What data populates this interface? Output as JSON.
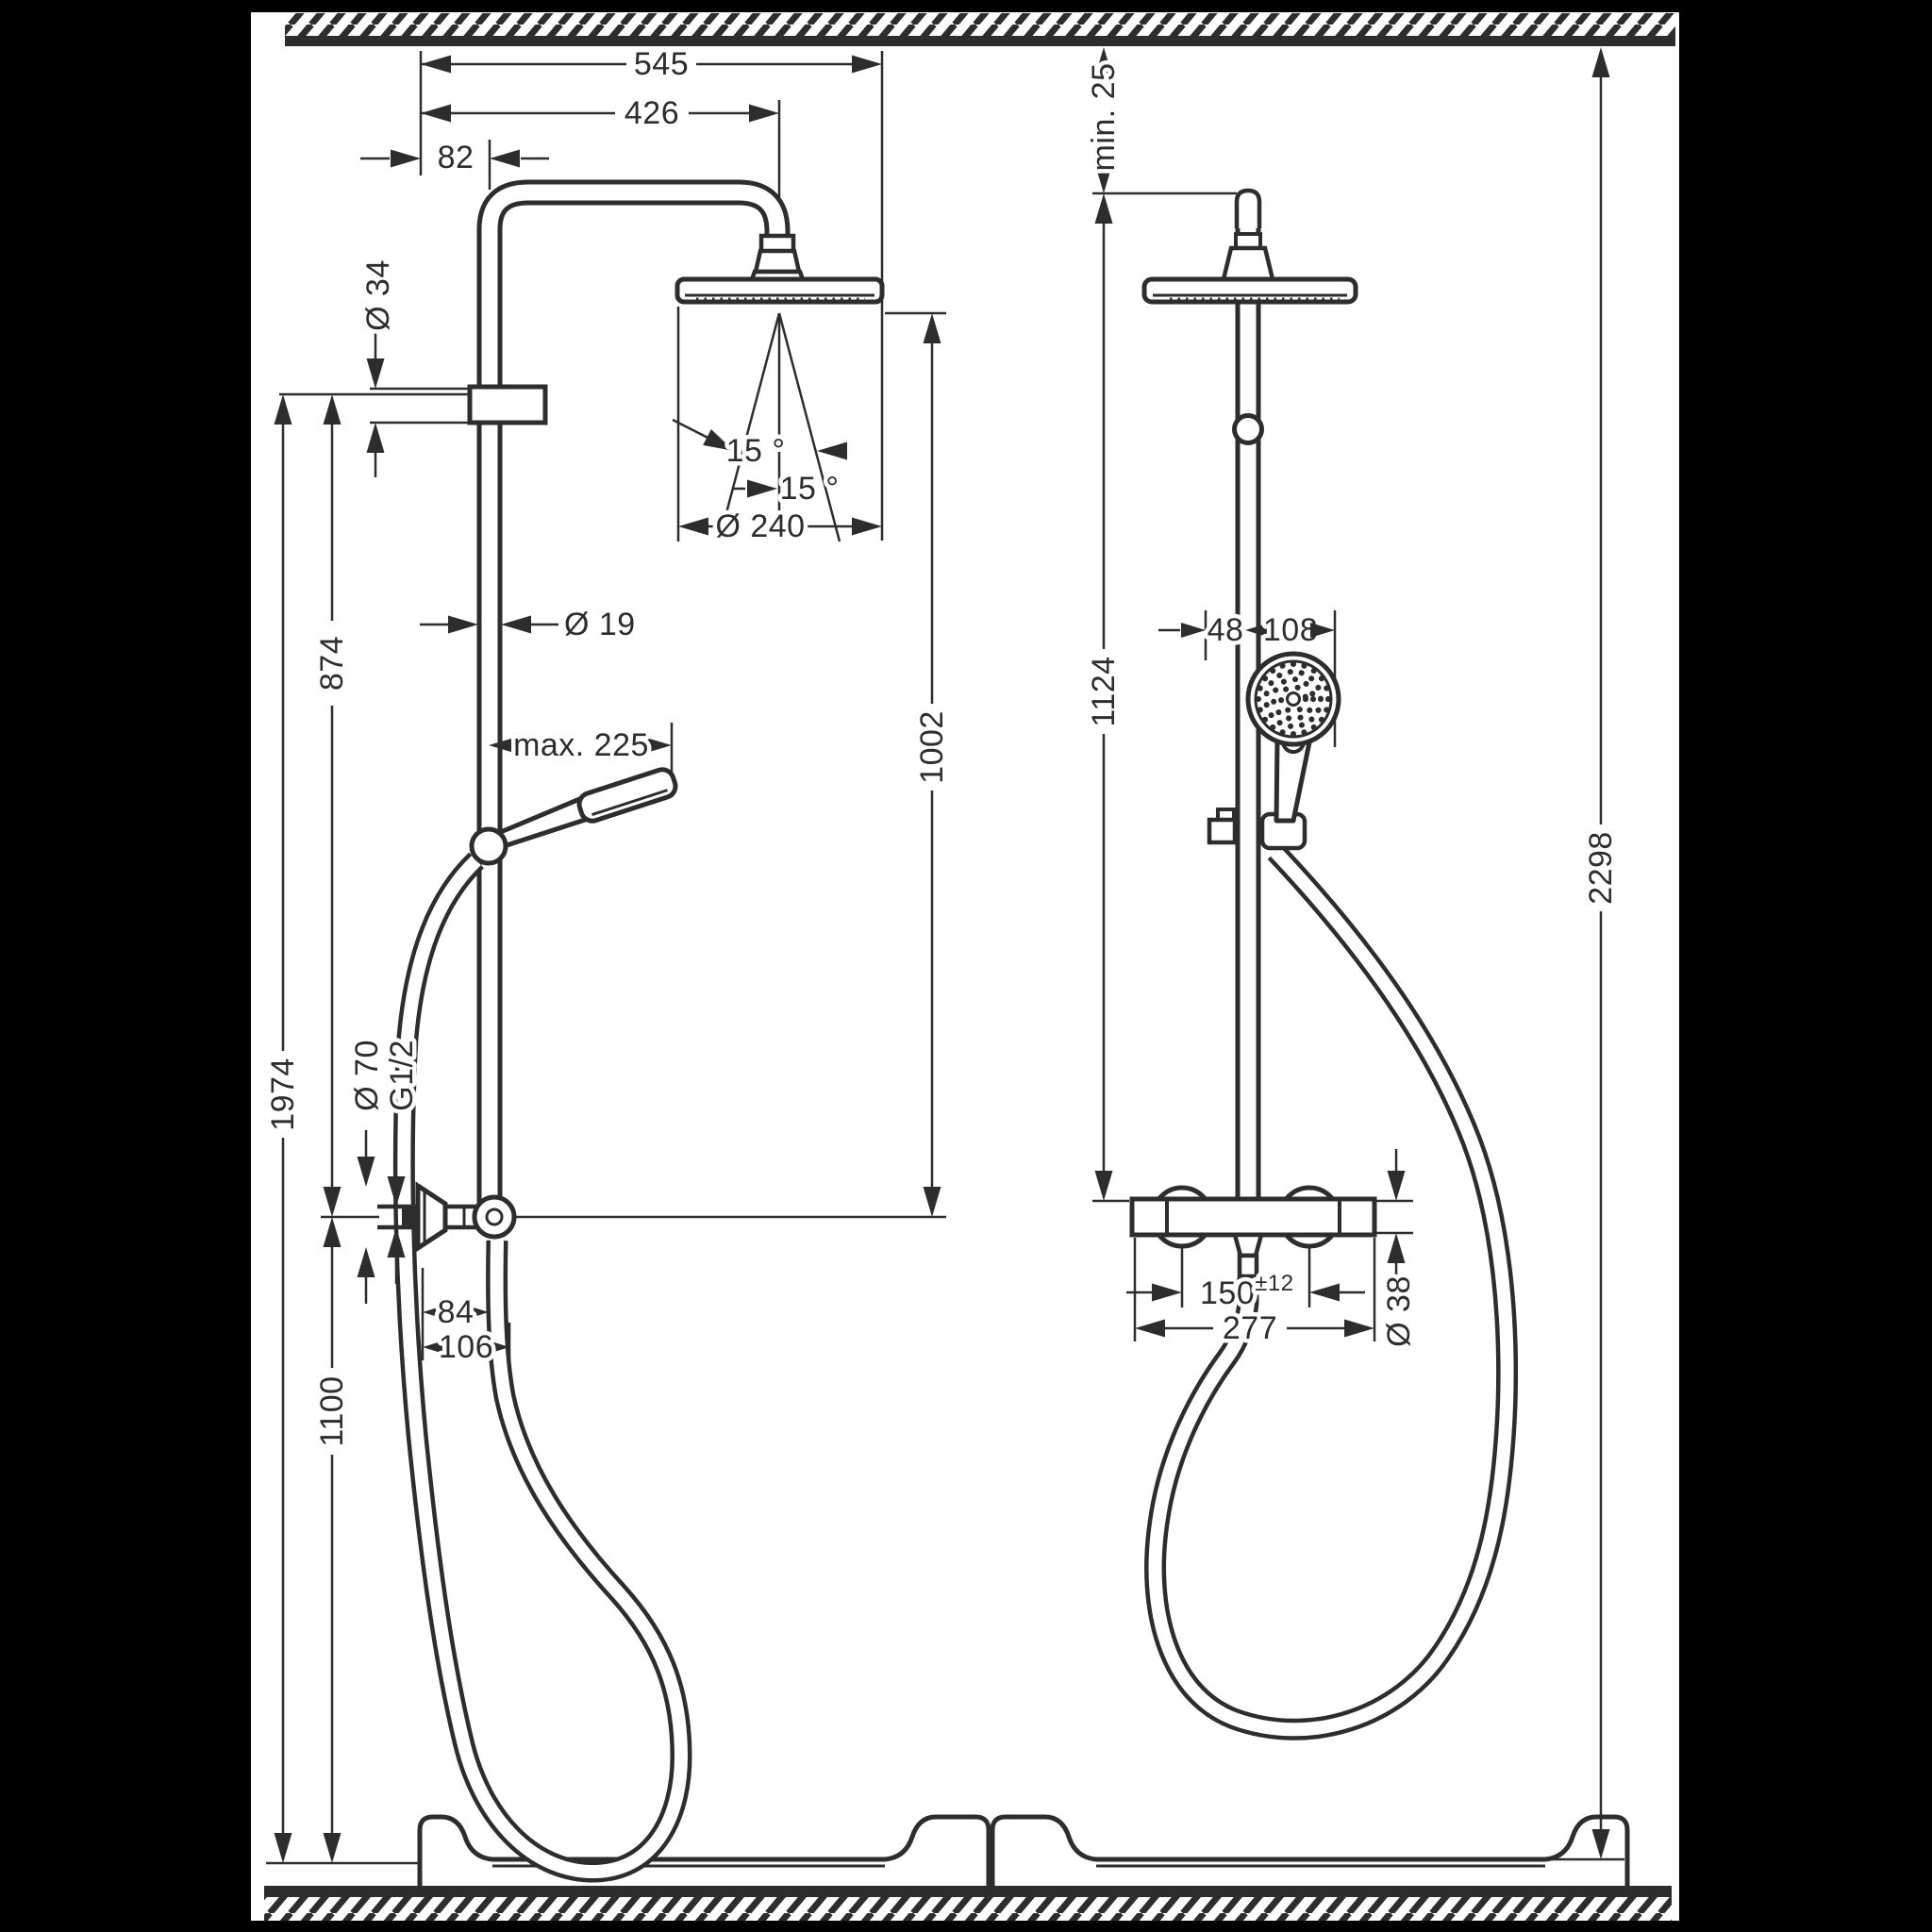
{
  "drawing": {
    "type": "product-dimension-drawing",
    "subject": "shower-system-with-overhead-and-hand-shower",
    "colors": {
      "line": "#2d2d2d",
      "background": "#ffffff",
      "frame": "#000000"
    },
    "front_view": {
      "dims": {
        "total_width": "545",
        "head_center_offset": "426",
        "wall_to_pipe": "82",
        "holder_dia": "Ø 34",
        "pipe_dia": "Ø 19",
        "handshower_reach": "max. 225",
        "spray_angle_a": "15 °",
        "spray_angle_b": "15 °",
        "head_dia": "Ø 240",
        "head_to_outlet": "1002",
        "bracket_to_outlet": "874",
        "bracket_height": "1974",
        "outlet_height": "1100",
        "escutcheon_dia": "Ø 70",
        "thread_size": "G1/2",
        "hose_offset_near": "84",
        "hose_offset_far": "106"
      }
    },
    "side_view": {
      "dims": {
        "ceiling_clearance": "min. 25",
        "pipe_top_to_valve": "1124",
        "overall_height": "2298",
        "wall_to_pipe": "48",
        "pipe_to_handshower": "108",
        "supply_centers": "150",
        "supply_tolerance": "±12",
        "valve_width": "277",
        "valve_body_dia": "Ø 38"
      }
    }
  }
}
